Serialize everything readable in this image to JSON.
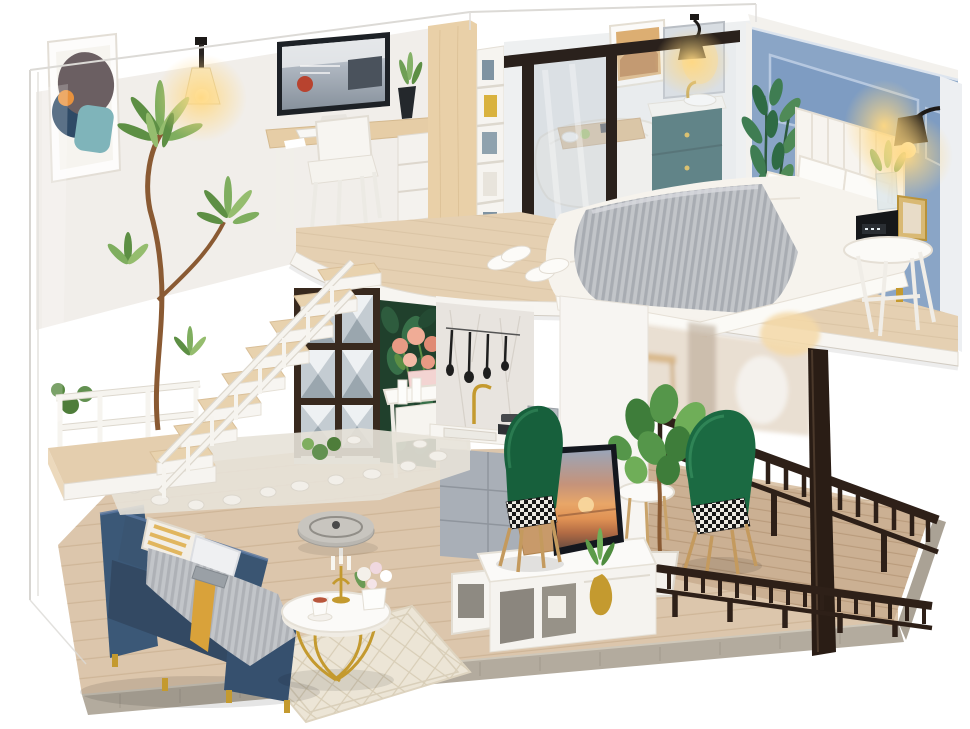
{
  "meta": {
    "domain": "natural-image",
    "subject": "Product photo of a DIY miniature dollhouse: a modern two-story loft apartment model with LED lights, shown inside a clear acrylic dust cover on a white background",
    "view": "three-quarter front-right elevated view",
    "visible_text": []
  },
  "palette": {
    "bg": "#ffffff",
    "glass": "#d8d6d2",
    "wallWhite": "#f1eeea",
    "wallCool": "#eef0f1",
    "wallWood": "#e9d0a8",
    "woodDesk": "#e6cda6",
    "woodLoft": "#e5d0b2",
    "woodFloor": "#dcc6ac",
    "woodDeck": "#cbb093",
    "woodStep": "#e8d2ae",
    "fascia": "#f7f5f1",
    "baseEdge": "#b3ab9e",
    "wallBlue": "#8aa5c6",
    "wallBluePanel": "#7e9cc2",
    "wallBlueLine": "#b6c8e0",
    "navy": "#3b5877",
    "navyDark": "#334963",
    "navyLight": "#5a78a2",
    "blanket": "#c2c5c9",
    "mustard": "#d9a23a",
    "yellow": "#f0b43c",
    "teal": "#2c5b5f",
    "greenChair": "#17603c",
    "leaf": "#5d8f44",
    "leafLight": "#7fae5f",
    "leafDark": "#2f6b45",
    "railDark": "#2e2018",
    "gold": "#c49a2f",
    "marble": "#e8e4df",
    "grayCab": "#a9afb7",
    "tvFrame": "#14171e",
    "rug": "#ece5d6",
    "rugLine": "#d8cdb6",
    "pebble": "#f2efe9",
    "cream": "#fbfaf8",
    "glow": "#ffd882"
  },
  "scene": {
    "display_case": "clear acrylic dust cover",
    "rooms": [
      {
        "name": "home-office",
        "items": [
          "abstract-wall-art",
          "wall-sconce-lamp",
          "computer-monitor",
          "wood-desk",
          "white-chair",
          "black-vase-plant",
          "bookshelf",
          "wood-partition"
        ]
      },
      {
        "name": "bathroom",
        "items": [
          "black-frame-glass-partition",
          "bathtub",
          "wood-bath-tray",
          "teal-vanity-cabinet",
          "gold-faucet",
          "mirror",
          "wall-art",
          "wall-sconce-lamp"
        ]
      },
      {
        "name": "bedroom",
        "items": [
          "blue-panel-wall",
          "white-headboard",
          "double-bed",
          "gray-knit-blanket",
          "white-pillows",
          "yellow-triangle-pillow",
          "green-plant",
          "black-wall-sconce",
          "round-bedside-table",
          "alarm-clock",
          "photo-frame",
          "slippers"
        ]
      },
      {
        "name": "living-room",
        "items": [
          "navy-sofa",
          "striped-pillow",
          "gray-throw",
          "mustard-throw",
          "remote-control",
          "round-marble-coffee-table",
          "gold-candelabra",
          "flower-vase",
          "coffee-cup",
          "robot-vacuum",
          "diamond-pattern-rug"
        ]
      },
      {
        "name": "kitchen",
        "items": [
          "marble-backsplash",
          "hanging-utensils",
          "gold-faucet",
          "sink-counter",
          "cooktop-with-pot",
          "silver-oven",
          "gray-cabinet",
          "green-velvet-dining-chair"
        ]
      },
      {
        "name": "media-wall",
        "items": [
          "flatscreen-tv-sunset",
          "white-media-console",
          "wooden-box",
          "gold-floor-vase",
          "white-storage-cube"
        ]
      },
      {
        "name": "stairwell",
        "items": [
          "floating-wood-stairs",
          "white-stair-railing",
          "landing-platform",
          "white-pebble-garden",
          "tall-curved-plant",
          "mirror-facet-screen",
          "white-console-table",
          "rose-bouquet",
          "dark-foliage-wall"
        ]
      },
      {
        "name": "balcony",
        "items": [
          "wood-deck",
          "dark-wood-railing",
          "dark-support-post",
          "green-velvet-armchair",
          "potted-tree",
          "round-side-table"
        ]
      }
    ]
  }
}
